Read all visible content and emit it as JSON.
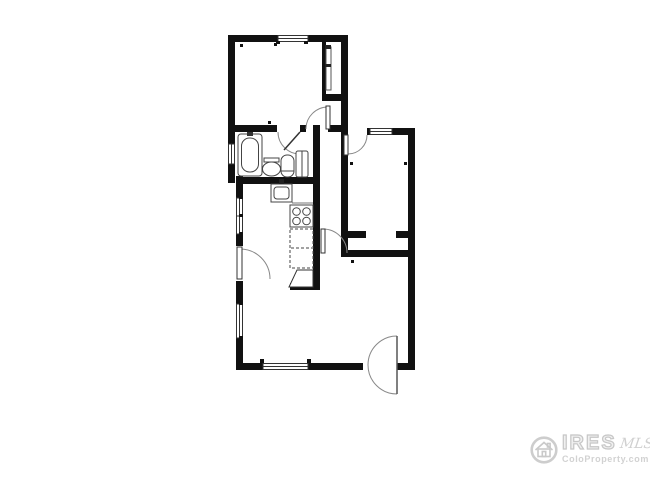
{
  "watermark": {
    "brand": "IRES",
    "mls": "MLS",
    "site": "ColoProperty.com",
    "copyright": "© IRES"
  },
  "colors": {
    "walls": "#111111",
    "fixtures": "#555555",
    "door_arcs": "#888888",
    "watermark": "#d2d2d2",
    "background": "#ffffff"
  }
}
